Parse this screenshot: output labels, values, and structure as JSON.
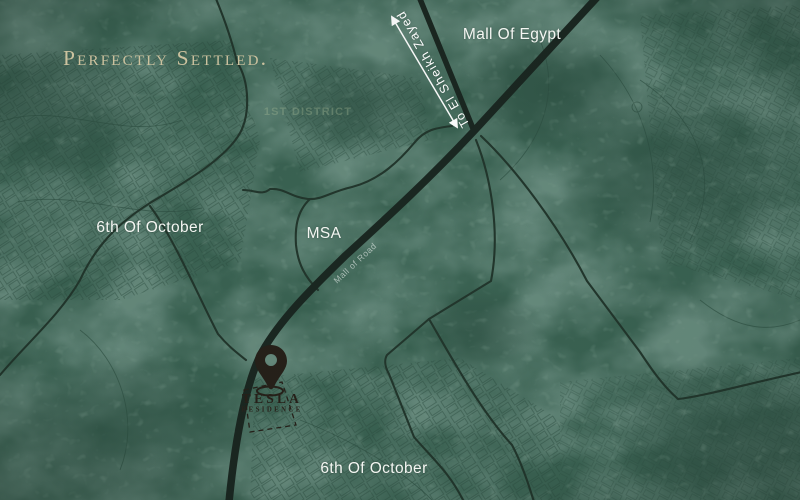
{
  "branding": {
    "tagline": "Perfectly Settled."
  },
  "map_labels": {
    "mall_of_egypt": "Mall Of Egypt",
    "district_west": "6th Of October",
    "district_south": "6th Of October",
    "msa": "MSA",
    "faint_district": "1st District",
    "road_name": "Mall of Road",
    "direction_arrow": "To El Sheikh Zayed"
  },
  "logo": {
    "title": "TESLA",
    "subtitle": "RESIDENCE"
  },
  "colors": {
    "map_background": "#3a6252",
    "map_texture_dark": "#2c4e41",
    "map_texture_light": "#4d7561",
    "road_dark": "#1a2721",
    "road_thin": "#22362c",
    "label_white": "#f4f6f2",
    "tagline_beige": "#ccc29f",
    "logo_dark": "#262019",
    "arrow_white": "#ffffff"
  }
}
